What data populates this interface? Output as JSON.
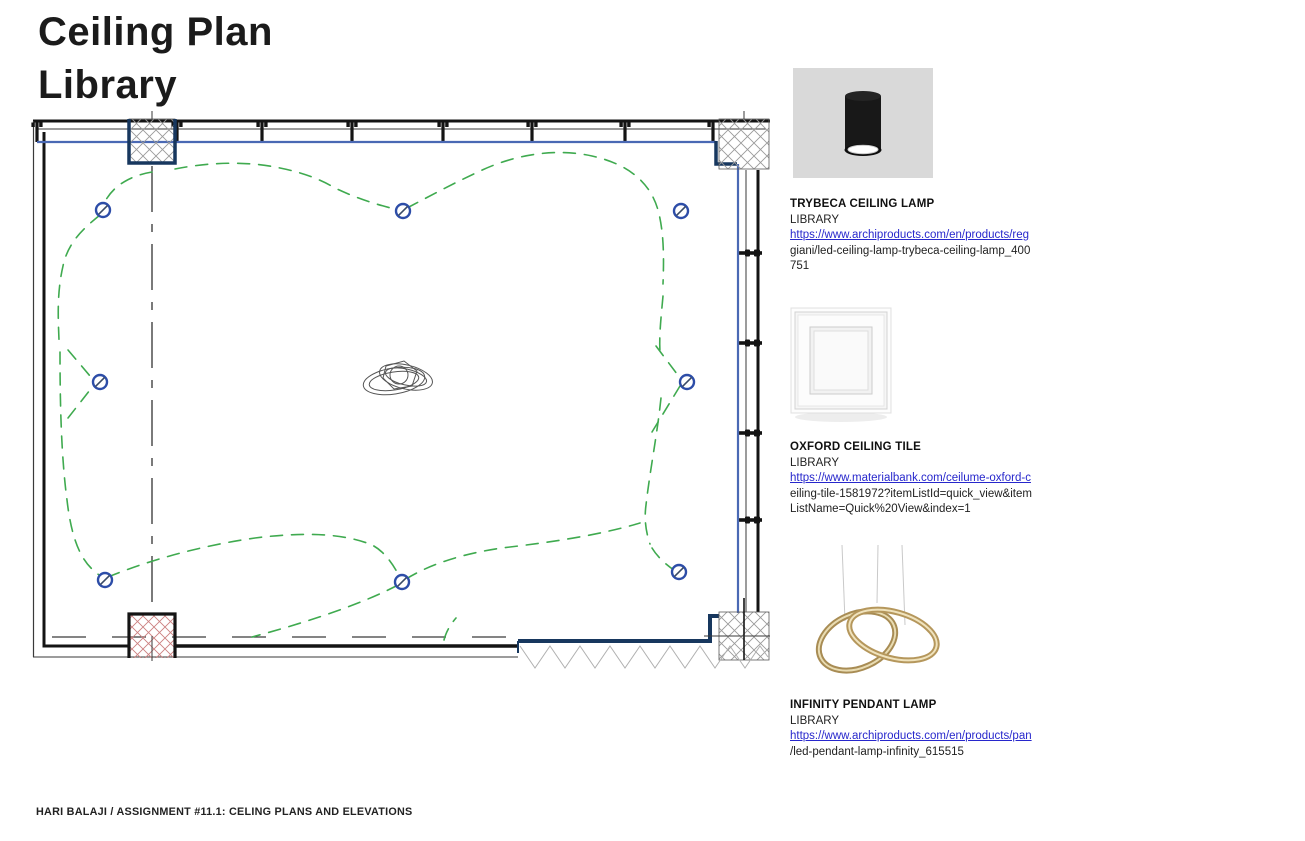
{
  "page": {
    "title_lines": [
      "Ceiling Plan",
      "Library"
    ],
    "footer": "HARI BALAJI / ASSIGNMENT #11.1: CELING PLANS AND ELEVATIONS"
  },
  "products": [
    {
      "name": "TRYBECA CEILING LAMP",
      "collection": "LIBRARY",
      "url_linked": "https://www.archiproducts.com/en/products/reg",
      "url_wrap": [
        "giani/led-ceiling-lamp-trybeca-ceiling-lamp_400",
        "751"
      ],
      "image": "black-cylindrical-ceiling-lamp"
    },
    {
      "name": "OXFORD CEILING TILE",
      "collection": "LIBRARY",
      "url_linked": "https://www.materialbank.com/ceilume-oxford-c",
      "url_wrap": [
        "eiling-tile-1581972?itemListId=quick_view&item",
        "ListName=Quick%20View&index=1"
      ],
      "image": "white-coffered-ceiling-tile"
    },
    {
      "name": "INFINITY PENDANT LAMP",
      "collection": "LIBRARY",
      "url_linked": "https://www.archiproducts.com/en/products/pan",
      "url_wrap": [
        "/led-pendant-lamp-infinity_615515"
      ],
      "image": "gold-infinity-pendant-lamp"
    }
  ],
  "plan": {
    "label": "library-reflected-ceiling-plan",
    "downlights": [
      {
        "x": 103,
        "y": 210
      },
      {
        "x": 403,
        "y": 211
      },
      {
        "x": 681,
        "y": 211
      },
      {
        "x": 100,
        "y": 382
      },
      {
        "x": 687,
        "y": 382
      },
      {
        "x": 105,
        "y": 580
      },
      {
        "x": 402,
        "y": 582
      },
      {
        "x": 679,
        "y": 572
      }
    ],
    "pendant_center": {
      "x": 400,
      "y": 379
    },
    "colors": {
      "wiring_green": "#3faa4f",
      "symbol_blue": "#2d4da8",
      "wall_blue": "#4a69b4",
      "wall_navy": "#17375e",
      "hatch_red": "#cc8080",
      "hatch_gray": "#9a9a9a"
    }
  }
}
